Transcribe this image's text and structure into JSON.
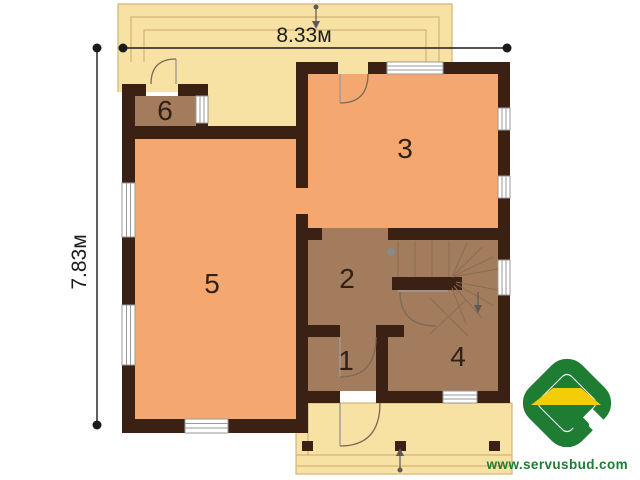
{
  "plan": {
    "dimension_width": "8.33м",
    "dimension_height": "7.83м",
    "rooms": [
      {
        "number": "1"
      },
      {
        "number": "2"
      },
      {
        "number": "3"
      },
      {
        "number": "4"
      },
      {
        "number": "5"
      },
      {
        "number": "6"
      }
    ],
    "colors": {
      "wall": "#3b2114",
      "room_warm": "#f4a870",
      "room_brown": "#a37c5d",
      "porch": "#f7e2a3",
      "porch_line": "#d2b478",
      "window_fill": "#ffffff",
      "window_frame": "#9a9a9a",
      "door_line": "#7b6a55",
      "door_leaf": "#9b9b9b",
      "stair_line": "#8a6d52",
      "stair_dot": "#8a8a8a",
      "arrow": "#5a5a5a",
      "dimension": "#1b1b1b",
      "label": "#332014",
      "logo_green": "#1e7c33",
      "logo_yellow": "#f4cd06"
    }
  },
  "branding": {
    "website": "www.servusbud.com"
  }
}
